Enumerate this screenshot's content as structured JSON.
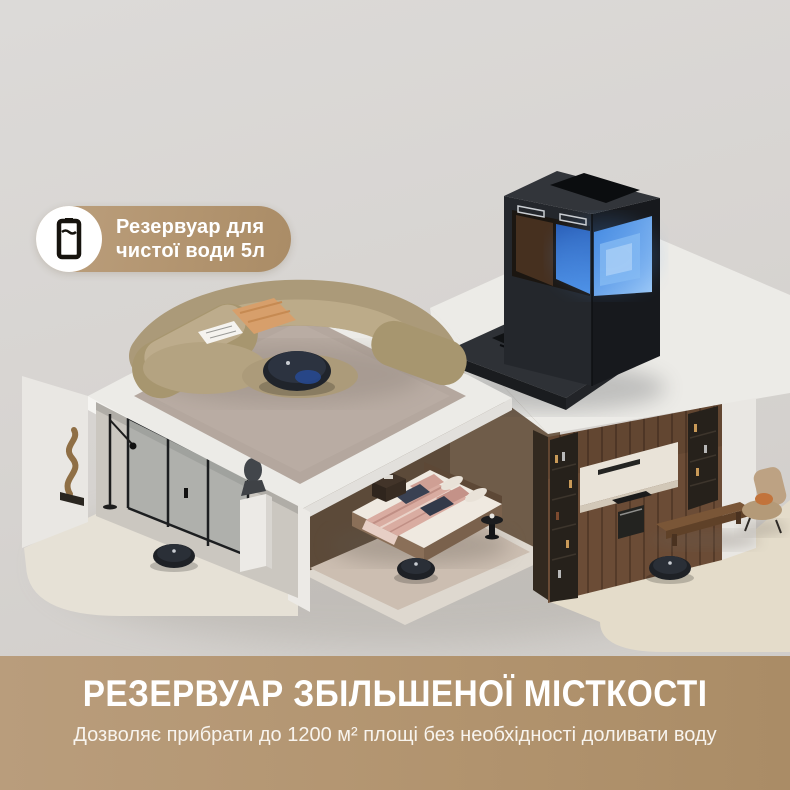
{
  "page": {
    "width": 790,
    "height": 790,
    "background": "#d7d4d1"
  },
  "callout_badge": {
    "icon": "water-tank-icon",
    "text_line1": "Резервуар для",
    "text_line2": "чистої води 5л",
    "pill_color": "#b2946f",
    "text_color": "#ffffff"
  },
  "banner": {
    "title": "РЕЗЕРВУАР ЗБІЛЬШЕНОЇ МІСТКОСТІ",
    "subtitle": "Дозволяє прибрати до 1200 м² площі без необхідності доливати воду",
    "background_left": "#b99d7c",
    "background_right": "#aa8c66",
    "text_color": "#ffffff"
  },
  "scene": {
    "objects": [
      "dock-station",
      "clean-water-tank",
      "dirty-water-tank",
      "dock-ramp",
      "living-room-rug",
      "curved-sofa",
      "throw-blanket",
      "newspaper",
      "robot-vacuum-living-room",
      "robot-vacuum-hallway",
      "robot-vacuum-bedroom",
      "robot-vacuum-kitchen",
      "glass-sliding-doors",
      "abstract-sculpture",
      "floor-lamp",
      "bust-on-pedestal",
      "bed",
      "nightstand",
      "side-table",
      "bedroom-rug",
      "kitchen-cabinets",
      "wine-cabinet-left",
      "wine-cabinet-right",
      "oven",
      "cooktop",
      "armchair",
      "coffee-table-bench"
    ],
    "colors": {
      "clean_water_blue": "#4f93e8",
      "dock_black": "#24272c",
      "kitchen_wood": "#6b4c36",
      "sofa_beige": "#b09f7e",
      "roof_white": "#ecebe7"
    }
  }
}
